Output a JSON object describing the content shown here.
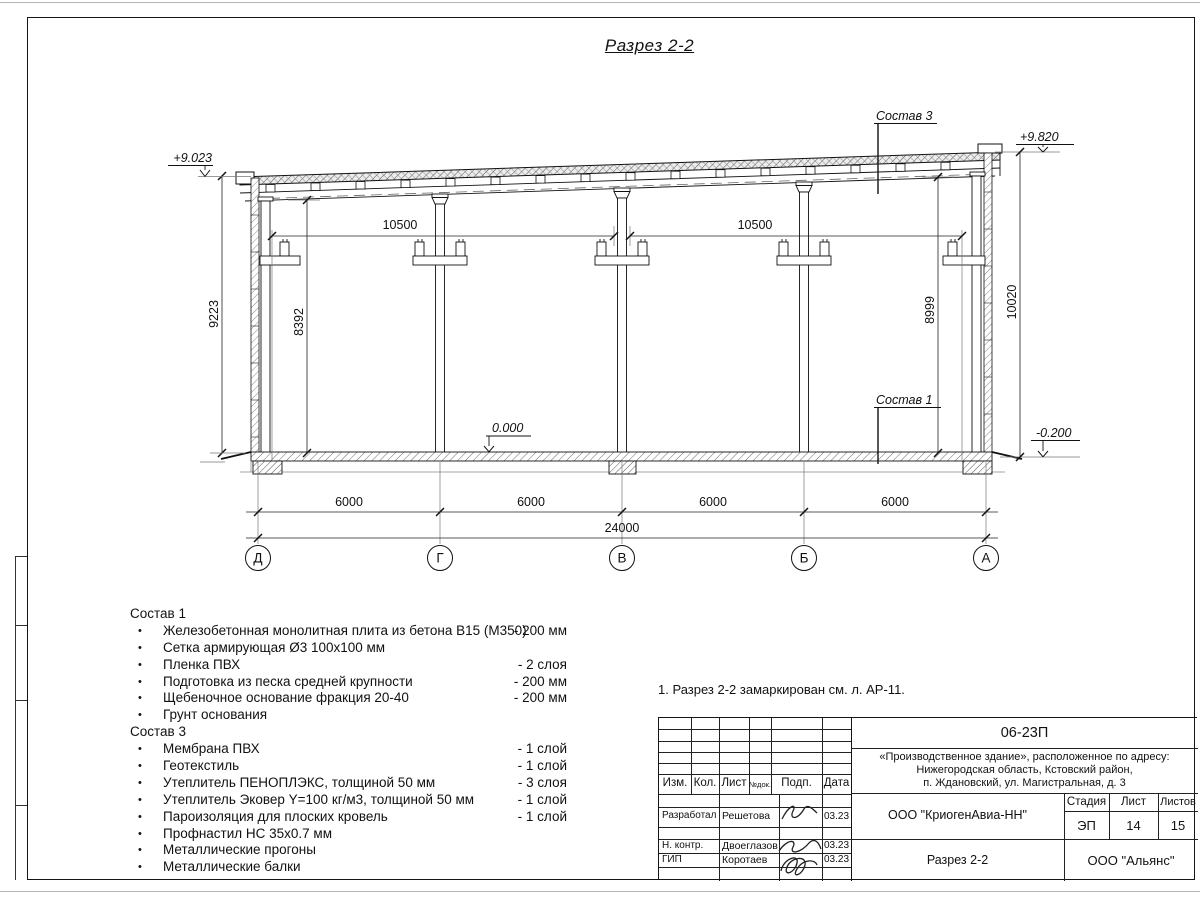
{
  "sheet": {
    "title": "Разрез 2-2"
  },
  "section": {
    "elev_left": "+9.023",
    "elev_right": "+9.820",
    "elev_floor": "0.000",
    "elev_ground": "-0.200",
    "label_sostav3": "Состав 3",
    "label_sostav1": "Состав 1",
    "dim_bay_left": "10500",
    "dim_bay_right": "10500",
    "dim_left_outer": "9223",
    "dim_left_inner": "8392",
    "dim_right_inner": "8999",
    "dim_right_outer": "10020",
    "spans": [
      "6000",
      "6000",
      "6000",
      "6000"
    ],
    "dim_total": "24000",
    "axes": [
      "Д",
      "Г",
      "В",
      "Б",
      "А"
    ]
  },
  "sostav1": {
    "title": "Состав 1",
    "items": [
      {
        "text": "Железобетонная монолитная плита из бетона В15 (М350)",
        "value": "-  200 мм"
      },
      {
        "text": "Сетка армирующая Ø3 100х100 мм",
        "value": ""
      },
      {
        "text": "Пленка ПВХ",
        "value": "-  2 слоя"
      },
      {
        "text": "Подготовка из песка средней крупности",
        "value": "- 200 мм"
      },
      {
        "text": "Щебеночное основание фракция 20-40",
        "value": "- 200 мм"
      },
      {
        "text": "Грунт основания",
        "value": ""
      }
    ]
  },
  "sostav3": {
    "title": "Состав 3",
    "items": [
      {
        "text": "Мембрана ПВХ",
        "value": "- 1 слой"
      },
      {
        "text": "Геотекстиль",
        "value": "- 1 слой"
      },
      {
        "text": "Утеплитель ПЕНОПЛЭКС, толщиной 50 мм",
        "value": "- 3 слоя"
      },
      {
        "text": "Утеплитель Эковер Y=100 кг/м3, толщиной 50 мм",
        "value": "- 1 слой"
      },
      {
        "text": "Пароизоляция для плоских кровель",
        "value": "- 1 слой"
      },
      {
        "text": "Профнастил НС 35х0.7 мм",
        "value": ""
      },
      {
        "text": "Металлические прогоны",
        "value": ""
      },
      {
        "text": "Металлические балки",
        "value": ""
      }
    ]
  },
  "note": "1. Разрез 2-2 замаркирован см. л. АР-11.",
  "titleblock": {
    "doc_number": "06-23П",
    "project_line1": "«Производственное здание», расположенное по адресу:",
    "project_line2": "Нижегородская область, Кстовский район,",
    "project_line3": "п. Ждановский, ул. Магистральная, д. 3",
    "col_izm": "Изм.",
    "col_kol": "Кол.",
    "col_list": "Лист",
    "col_doc": "№док.",
    "col_podp": "Подп.",
    "col_data": "Дата",
    "row_developed_label": "Разработал",
    "row_developed_name": "Решетова",
    "row_developed_date": "03.23",
    "row_ncontr_label": "Н. контр.",
    "row_ncontr_name": "Двоеглазов",
    "row_ncontr_date": "03.23",
    "row_gip_label": "ГИП",
    "row_gip_name": "Коротаев",
    "row_gip_date": "03.23",
    "org": "ООО \"КриогенАвиа-НН\"",
    "stage_label": "Стадия",
    "sheet_label": "Лист",
    "sheets_label": "Листов",
    "stage": "ЭП",
    "sheet_no": "14",
    "sheets_total": "15",
    "drawing_name": "Разрез 2-2",
    "company": "ООО \"Альянс\""
  }
}
